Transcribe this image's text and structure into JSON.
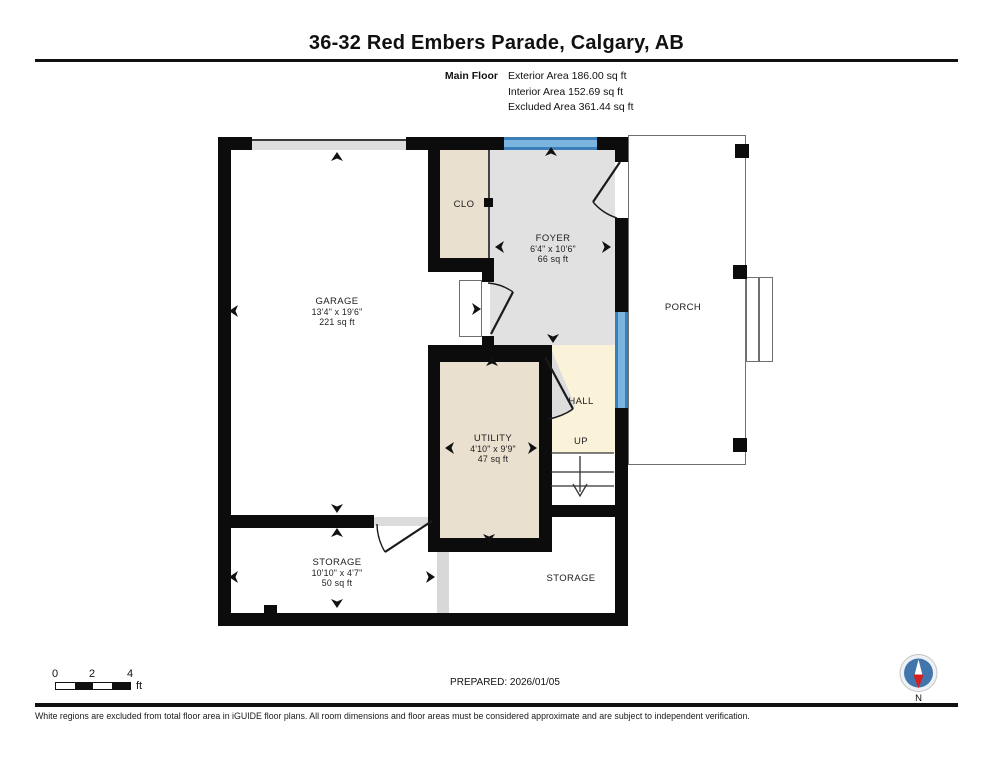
{
  "header": {
    "title": "36-32 Red Embers Parade, Calgary, AB",
    "floor_label": "Main Floor",
    "stats": [
      "Exterior Area 186.00 sq ft",
      "Interior Area 152.69 sq ft",
      "Excluded Area 361.44 sq ft"
    ]
  },
  "rooms": {
    "garage": {
      "name": "GARAGE",
      "dims": "13'4\" x 19'6\"",
      "area": "221 sq ft"
    },
    "closet": {
      "name": "CLO"
    },
    "foyer": {
      "name": "FOYER",
      "dims": "6'4\" x 10'6\"",
      "area": "66 sq ft"
    },
    "porch": {
      "name": "PORCH"
    },
    "hall": {
      "name": "HALL"
    },
    "stairs": {
      "name": "UP"
    },
    "utility": {
      "name": "UTILITY",
      "dims": "4'10\" x 9'9\"",
      "area": "47 sq ft"
    },
    "storage_left": {
      "name": "STORAGE",
      "dims": "10'10\" x 4'7\"",
      "area": "50 sq ft"
    },
    "storage_right": {
      "name": "STORAGE"
    }
  },
  "footer": {
    "scale_ticks": [
      "0",
      "2",
      "4"
    ],
    "scale_unit": "ft",
    "prepared": "PREPARED: 2026/01/05",
    "compass_label": "N",
    "disclaimer": "White regions are excluded from total floor area in iGUIDE floor plans. All room dimensions and floor areas must be considered approximate and are subject to independent verification."
  },
  "colors": {
    "wall": "#0c0c0c",
    "window_blue": "#7ab5e0",
    "window_frame": "#3c7fb8",
    "room_tan": "#e9e0cf",
    "room_gray": "#e1e1e1",
    "room_cream": "#faf3da",
    "compass_blue": "#4176ad",
    "compass_red": "#d42020"
  }
}
